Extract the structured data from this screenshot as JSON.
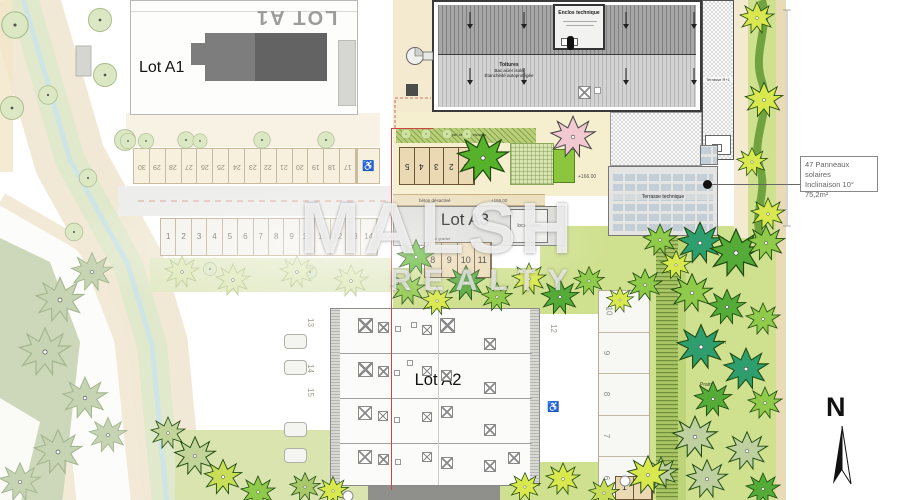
{
  "lots": {
    "a1_big": "LOT A1",
    "a1": "Lot A1",
    "a2": "Lot A2",
    "a3": "Lot A3"
  },
  "annotation": {
    "line1": "47 Panneaux solaires",
    "line2": "Inclinaison 10°",
    "line3": "75,2m²"
  },
  "roof": {
    "enclos": "Enclos technique",
    "line1": "Toitures",
    "line2": "Bac acier isolé",
    "line3": "Étanchéité autoprotégée"
  },
  "labels": {
    "terrasse_tech": "Terrasse technique",
    "terrasse_r1": "Terrasse R+1",
    "velos": "local vélos",
    "beton": "béton désactivé",
    "gravier": "sol gravier",
    "massif": "massif arbustif vivaces",
    "noue": "noue d'infiltration",
    "prairie": "Prairie",
    "elev_a": "+166.00",
    "elev_b": "+166.00"
  },
  "parking": {
    "row_a1": [
      "30",
      "29",
      "28",
      "27",
      "26",
      "25",
      "24",
      "23",
      "22",
      "21",
      "20",
      "19",
      "18",
      "17"
    ],
    "row_mid": [
      "1",
      "2",
      "3",
      "4",
      "5",
      "6",
      "7",
      "8",
      "9",
      "10",
      "11",
      "12",
      "13",
      "14"
    ],
    "row_a3_upper": [
      "5",
      "4",
      "3",
      "2",
      "1"
    ],
    "row_a3_lower": [
      "8",
      "9",
      "10",
      "11"
    ],
    "col_right": [
      "10",
      "9",
      "8",
      "7",
      "6"
    ],
    "a2_side_left": [
      "13",
      "14",
      "15"
    ],
    "a2_side_right": [
      "12"
    ],
    "bottom_right": [
      "1",
      "2"
    ]
  },
  "icons": {
    "disabled": "♿"
  },
  "watermark": {
    "line1": "MALSH",
    "line2": "REALTY"
  },
  "north": "N"
}
